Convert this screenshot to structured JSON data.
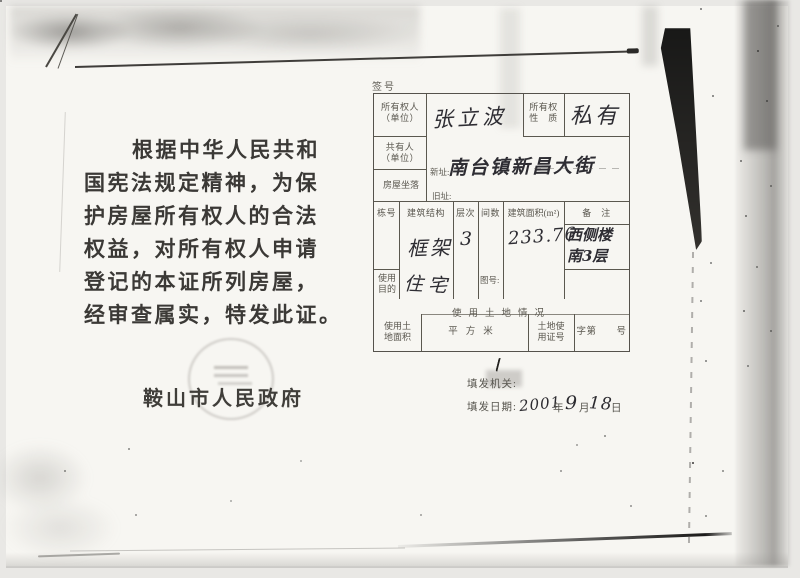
{
  "left_page": {
    "body_lines": [
      "根据中华人民共和",
      "国宪法规定精神，为保",
      "护房屋所有权人的合法",
      "权益，对所有权人申请",
      "登记的本证所列房屋，",
      "经审查属实，特发此证。"
    ],
    "issuer": "鞍山市人民政府"
  },
  "form": {
    "serial_label": "签号",
    "owner_label_lines": [
      "所有权人",
      "（单位）"
    ],
    "owner_value": "张立波",
    "nature_label_lines": [
      "所有权",
      "性　质"
    ],
    "nature_value": "私有",
    "coowner_label_lines": [
      "共有人",
      "（单位）"
    ],
    "location_label": "房屋坐落",
    "new_addr_label": "新址:",
    "new_addr_value": "南台镇新昌大街",
    "old_addr_label": "旧址:",
    "building_headers": [
      "栋号",
      "建筑结构",
      "层次",
      "间数",
      "建筑面积(m²)",
      "备　注"
    ],
    "structure_value": "框架",
    "floors_value": "3",
    "area_value": "233.76",
    "remark_lines": [
      "西侧楼",
      "南3层"
    ],
    "purpose_label_lines": [
      "使用",
      "目的"
    ],
    "purpose_value": "住宅",
    "map_no_label": "图号:",
    "land_title": "使用土地情况",
    "land_area_label_lines": [
      "使用土",
      "地面积"
    ],
    "land_unit": "平方米",
    "land_cert_label_lines": [
      "土地使",
      "用证号"
    ],
    "land_zi_label": "字第　　号",
    "agency_label": "填发机关:",
    "date_label": "填发日期:",
    "date_year": "2001",
    "date_year_unit": "年",
    "date_month": "9",
    "date_month_unit": "月",
    "date_day": "18",
    "date_day_unit": "日"
  },
  "colors": {
    "paper": "#f7f6f2",
    "scan_background": "#e9e8e5",
    "print_ink": "#3b3936",
    "form_ink": "#55534c",
    "handwriting_ink": "#2e2d33"
  }
}
